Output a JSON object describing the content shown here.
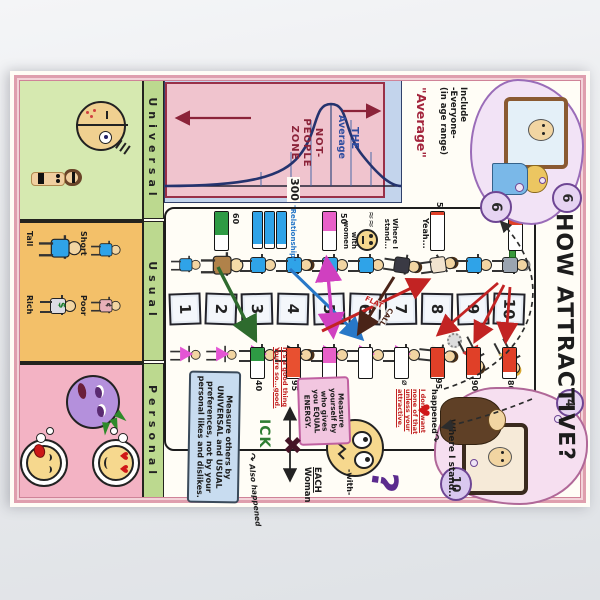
{
  "poster": {
    "title": "HOW ATTRACTIVE?",
    "header": {
      "left_bubble": {
        "mirror_rating": "6",
        "thought_rating": "6"
      },
      "right_bubble": {
        "thought_rating": "4",
        "screen_rating": "10"
      },
      "include_note": {
        "line1": "Include",
        "line2": "-Everyone-",
        "line3": "(in age range)"
      },
      "average_quote": "\"Average\""
    },
    "distribution": {
      "the": "THE",
      "average": "Average",
      "zone1": "NOT-",
      "zone2": "PEOPLE",
      "zone3": "ZONE",
      "count": "300"
    },
    "scale": {
      "numbers": [
        "1",
        "2",
        "3",
        "4",
        "5",
        "6",
        "7",
        "8",
        "9",
        "10"
      ]
    },
    "men_side": {
      "bars": [
        {
          "level": "2",
          "value": "60"
        },
        {
          "level": "5",
          "value": "50"
        },
        {
          "level": "8",
          "value": "5"
        },
        {
          "level": "10",
          "value": "35"
        }
      ],
      "relationship_label": "\"Relationship\"",
      "stand_note": {
        "line1": "Where I",
        "line2": "stand...",
        "line3": "with",
        "line4": "women"
      },
      "yeah_note": "Yeah..."
    },
    "women_side": {
      "bars": [
        {
          "level": "3",
          "value": "40"
        },
        {
          "level": "4",
          "value": "95"
        },
        {
          "level": "5",
          "value": "50"
        },
        {
          "level": "6",
          "value": ""
        },
        {
          "level": "7",
          "value": "⌀"
        },
        {
          "level": "8",
          "value": "95"
        },
        {
          "level": "9",
          "value": "90"
        },
        {
          "level": "10",
          "value": "80"
        }
      ],
      "good_thing_note": {
        "line1": "It's a good thing",
        "line2": "You're so...good."
      },
      "dont_want_note": {
        "line1": "I don't want",
        "line2": "none of that",
        "line3": "unless your",
        "line4": "attractive."
      }
    },
    "arrow_labels": {
      "flat": "FLAT",
      "call": "CALL"
    },
    "bottom_right": {
      "where_i_stand": "Where I stand..",
      "with": "-with-",
      "each": "EACH",
      "woman": "Woman",
      "ick": "ICK",
      "also_happened": "Also happened",
      "happened": "happened",
      "question_mark": "?",
      "measure_yourself": {
        "line1": "Measure",
        "line2": "yourself by",
        "line3": "who gives",
        "line4": "you EQUAL",
        "line5": "ENERGY."
      },
      "measure_others": {
        "line1": "Measure others by",
        "line2": "UNIVERSAL and USUAL",
        "line3": "preferences, not by your",
        "line4": "personal likes and dislikes."
      }
    },
    "sections": {
      "universal": {
        "label": "Universal",
        "symmetry": "Symmetry",
        "hair": "hair",
        "skin1": "Skin",
        "skin2": "(youth,",
        "skin3": "health)",
        "ratio_value": "7/10",
        "ratio_word": "ratio"
      },
      "usual": {
        "label": "Usual",
        "short": "Short",
        "tall": "Tall",
        "poor": "Poor",
        "rich": "Rich",
        "cent": "¢",
        "dollar": "$"
      },
      "personal": {
        "label": "Personal"
      }
    },
    "icons": {
      "heart": "♥",
      "cross": "✖",
      "check": "✔",
      "curl_arrow": "↷",
      "squiggle": "≈≈",
      "question": "?"
    },
    "colors": {
      "paper": "#fffdf6",
      "frame_pink": "#df9fae",
      "zone_pink": "#f0c4ce",
      "zone_border": "#993048",
      "dist_blue": "#c3d4ec",
      "curve_navy": "#24336e",
      "bar_green": "#2e9a44",
      "bar_red": "#e04028",
      "bar_pink": "#e860c8",
      "bar_blue": "#2fa3e8",
      "ick_green": "#2e7d32",
      "note_blue": "#c8dcf0",
      "note_pink": "#f2c6e0",
      "cloud_purple": "#9a6cb8"
    }
  }
}
